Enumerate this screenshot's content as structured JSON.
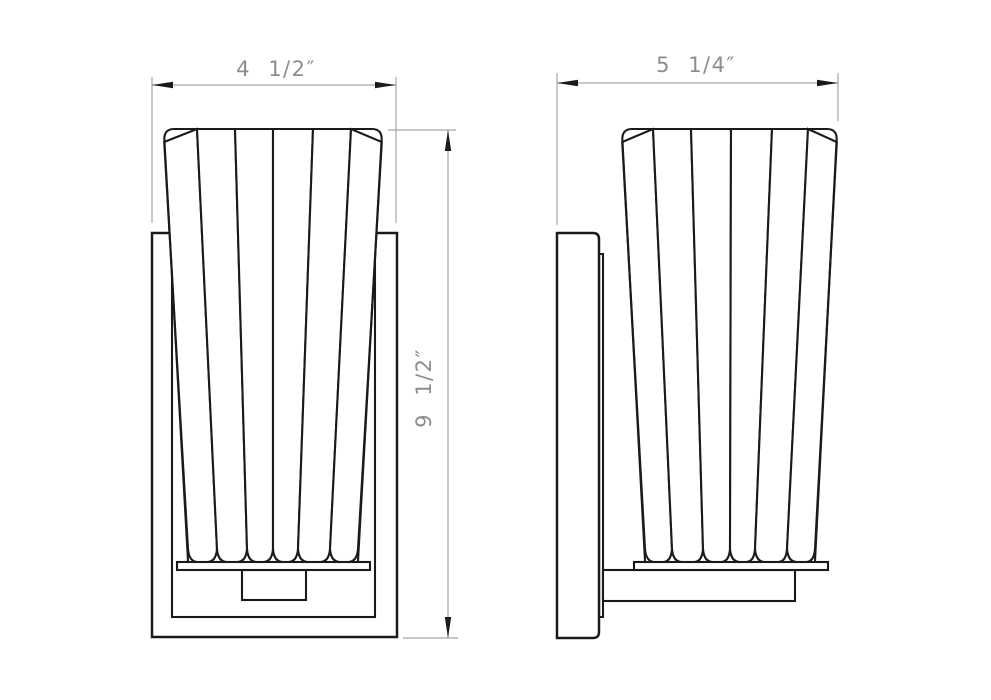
{
  "dimensions": {
    "front_width": {
      "label": "4 1/2″"
    },
    "side_depth": {
      "label": "5 1/4″"
    },
    "height": {
      "label": "9 1/2″"
    }
  },
  "colors": {
    "object_line": "#1a1a1a",
    "dimension_line": "#a6a6a6",
    "dimension_text": "#8d8d8d",
    "background": "#ffffff"
  }
}
